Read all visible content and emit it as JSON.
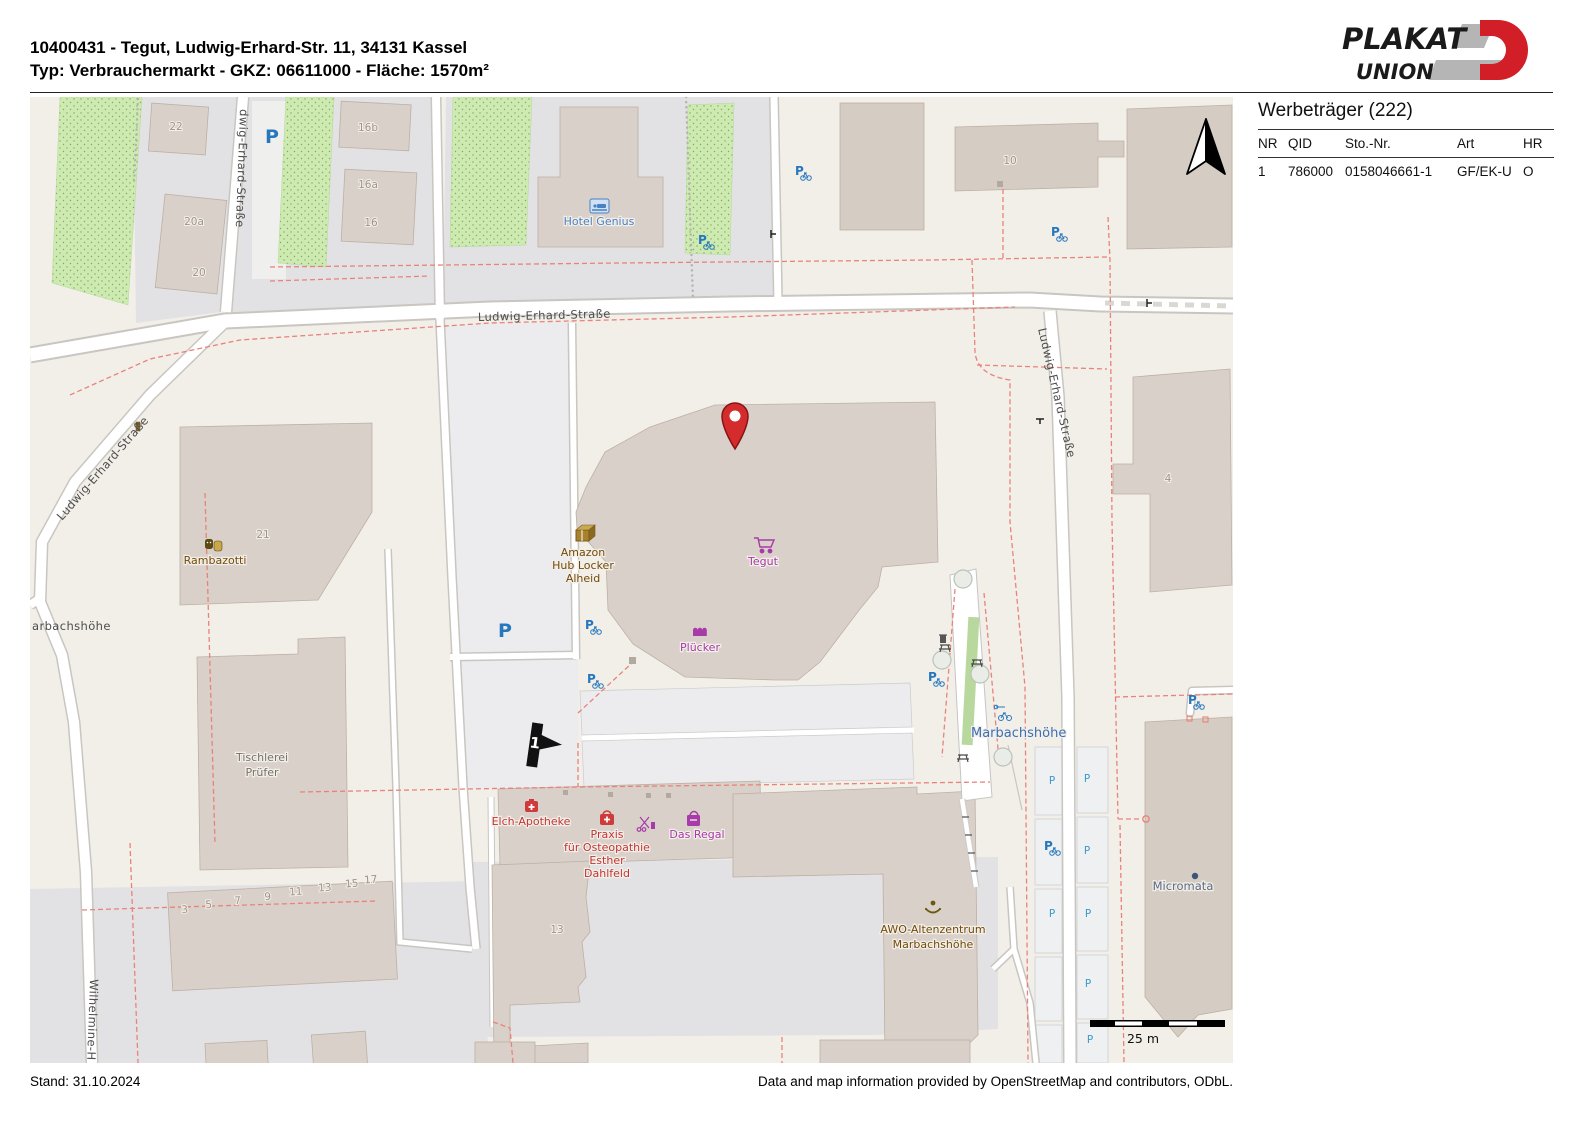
{
  "header": {
    "line1": "10400431 - Tegut, Ludwig-Erhard-Str. 11, 34131 Kassel",
    "line2": "Typ: Verbrauchermarkt - GKZ: 06611000 - Fläche: 1570m²"
  },
  "logo": {
    "plakat": "PLAKAT",
    "union": "UNION"
  },
  "sidebar": {
    "title": "Werbeträger (222)",
    "columns": [
      "NR",
      "QID",
      "Sto.-Nr.",
      "Art",
      "HR"
    ],
    "row": {
      "nr": "1",
      "qid": "786000",
      "sto_nr": "0158046661-1",
      "art": "GF/EK-U",
      "hr": "O"
    }
  },
  "footer": {
    "stand": "Stand: 31.10.2024",
    "attribution": "Data and map information provided by OpenStreetMap and contributors, ODbL."
  },
  "map": {
    "p": "P",
    "marker_number": "1",
    "scale_label": "25 m",
    "streets": {
      "s1": "dwig-Erhard-Straße",
      "s2": "Ludwig-Erhard-Straße",
      "s3": "Ludwig-Erhard-Straße",
      "s4": "Ludwig-Erhard-Straße",
      "s5": "Wilhelmine-H",
      "s6": "arbachshöhe"
    },
    "places": {
      "marbach": "Marbachshöhe"
    },
    "pois": {
      "hotel": "Hotel Genius",
      "amazon1": "Amazon",
      "amazon2": "Hub Locker",
      "amazon3": "Alheid",
      "tegut": "Tegut",
      "pluecker": "Plücker",
      "ramba": "Rambazotti",
      "tisch1": "Tischlerei",
      "tisch2": "Prüfer",
      "apo": "Elch-Apotheke",
      "prax1": "Praxis",
      "prax2": "für Osteopathie",
      "prax3": "Esther",
      "prax4": "Dahlfeld",
      "regal": "Das Regal",
      "awo1": "AWO-Altenzentrum",
      "awo2": "Marbachshöhe",
      "micro": "Micromata"
    },
    "numbers": {
      "n22": "22",
      "n20a": "20a",
      "n20": "20",
      "n16b": "16b",
      "n16a": "16a",
      "n16": "16",
      "n10": "10",
      "n4": "4",
      "n21": "21",
      "n13": "13"
    },
    "rownumbers": [
      "3",
      "5",
      "7",
      "9",
      "11",
      "13",
      "15",
      "17"
    ],
    "colors": {
      "background": "#f2efe9",
      "building": "#d9d0c9",
      "gray_area": "#e2e1e4",
      "green": "#cdebb0",
      "red_dash": "#e8837a",
      "parking_blue": "#2777bd",
      "pin_red": "#d42c2c",
      "shop_purple": "#a73ba7",
      "amenity_red": "#c43434"
    }
  }
}
